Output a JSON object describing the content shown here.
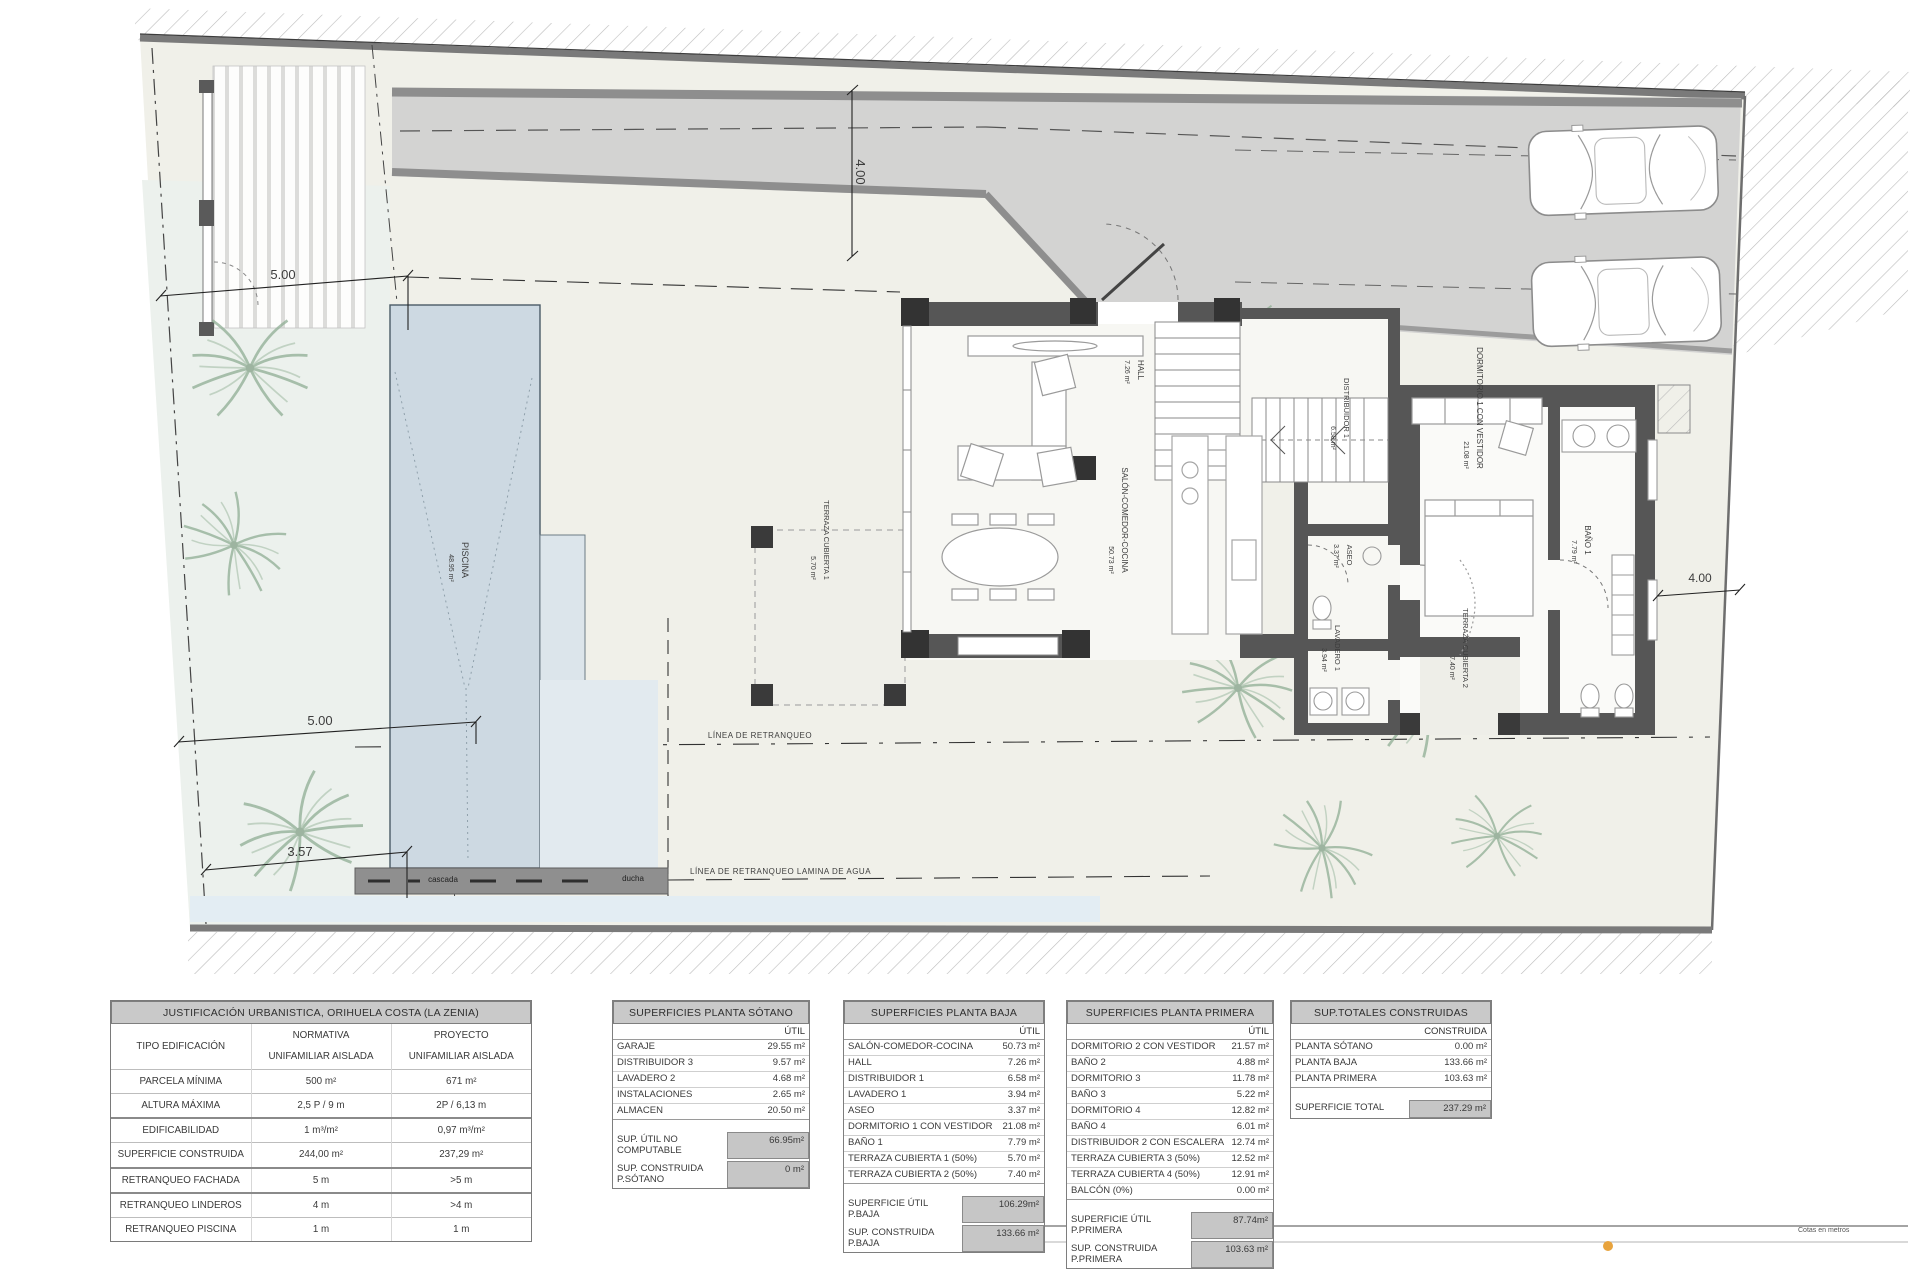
{
  "plan": {
    "colors": {
      "wall": "#565656",
      "pool": "#cdd9e2",
      "road": "#d3d3d2",
      "highlight": "#c6c6c6",
      "accent_dot": "#e8a33d"
    },
    "labels": [
      {
        "name": "dimension-label",
        "text": "5.00",
        "x": 283,
        "y": 279,
        "size": 13
      },
      {
        "name": "dimension-label",
        "text": "4.00",
        "x": 856,
        "y": 172,
        "size": 13,
        "rot": 90
      },
      {
        "name": "dimension-label",
        "text": "5.00",
        "x": 320,
        "y": 725,
        "size": 13
      },
      {
        "name": "dimension-label",
        "text": "3.57",
        "x": 300,
        "y": 856,
        "size": 13
      },
      {
        "name": "dimension-label",
        "text": "4.00",
        "x": 1700,
        "y": 582,
        "size": 12
      },
      {
        "name": "setback-line-label",
        "text": "LÍNEA DE RETRANQUEO",
        "x": 760,
        "y": 738,
        "size": 8,
        "anchor": "middle",
        "spacing": ".5"
      },
      {
        "name": "setback-line-label",
        "text": "LÍNEA DE RETRANQUEO LAMINA DE AGUA",
        "x": 690,
        "y": 874,
        "size": 8,
        "anchor": "start",
        "spacing": ".5"
      },
      {
        "name": "deck-label",
        "text": "cascada",
        "x": 443,
        "y": 882,
        "size": 8,
        "color": "#222"
      },
      {
        "name": "deck-label",
        "text": "ducha",
        "x": 633,
        "y": 881,
        "size": 8,
        "color": "#222"
      },
      {
        "name": "room-label",
        "text": "PISCINA",
        "x": 462,
        "y": 560,
        "size": 9,
        "rot": 90
      },
      {
        "name": "room-area-label",
        "text": "48.95 m²",
        "x": 449,
        "y": 568,
        "size": 7,
        "rot": 90
      },
      {
        "name": "room-label",
        "text": "HALL",
        "x": 1138,
        "y": 370,
        "size": 8,
        "rot": 90
      },
      {
        "name": "room-area-label",
        "text": "7.26 m²",
        "x": 1125,
        "y": 372,
        "size": 7,
        "rot": 90
      },
      {
        "name": "room-label",
        "text": "SALÓN-COMEDOR-COCINA",
        "x": 1122,
        "y": 520,
        "size": 8,
        "rot": 90
      },
      {
        "name": "room-area-label",
        "text": "50.73 m²",
        "x": 1109,
        "y": 560,
        "size": 7,
        "rot": 90
      },
      {
        "name": "room-label",
        "text": "DISTRIBUIDOR 1",
        "x": 1344,
        "y": 408,
        "size": 7.5,
        "rot": 90
      },
      {
        "name": "room-area-label",
        "text": "6.58 m²",
        "x": 1331,
        "y": 438,
        "size": 7,
        "rot": 90
      },
      {
        "name": "room-label",
        "text": "ASEO",
        "x": 1347,
        "y": 555,
        "size": 7.5,
        "rot": 90
      },
      {
        "name": "room-area-label",
        "text": "3.37 m²",
        "x": 1334,
        "y": 556,
        "size": 7,
        "rot": 90
      },
      {
        "name": "room-label",
        "text": "LAVADERO 1",
        "x": 1335,
        "y": 648,
        "size": 7.5,
        "rot": 90
      },
      {
        "name": "room-area-label",
        "text": "3.94 m²",
        "x": 1322,
        "y": 660,
        "size": 7,
        "rot": 90
      },
      {
        "name": "room-label",
        "text": "DORMITORIO 1 CON VESTIDOR",
        "x": 1477,
        "y": 408,
        "size": 8,
        "rot": 90
      },
      {
        "name": "room-area-label",
        "text": "21.08 m²",
        "x": 1464,
        "y": 455,
        "size": 7,
        "rot": 90
      },
      {
        "name": "room-label",
        "text": "BAÑO 1",
        "x": 1585,
        "y": 540,
        "size": 8,
        "rot": 90
      },
      {
        "name": "room-area-label",
        "text": "7.79 m²",
        "x": 1572,
        "y": 552,
        "size": 7,
        "rot": 90
      },
      {
        "name": "room-label",
        "text": "TERRAZA CUBIERTA 1",
        "x": 824,
        "y": 540,
        "size": 7.5,
        "rot": 90
      },
      {
        "name": "room-area-label",
        "text": "5.70 m²",
        "x": 811,
        "y": 568,
        "size": 7,
        "rot": 90
      },
      {
        "name": "room-label",
        "text": "TERRAZA CUBIERTA 2",
        "x": 1463,
        "y": 648,
        "size": 7.5,
        "rot": 90
      },
      {
        "name": "room-area-label",
        "text": "7.40 m²",
        "x": 1450,
        "y": 668,
        "size": 7,
        "rot": 90
      },
      {
        "name": "scale-zero-label",
        "text": "0",
        "x": 997,
        "y": 1238,
        "size": 9,
        "color": "#222"
      },
      {
        "name": "scale-note-label",
        "text": "Cotas en metros",
        "x": 1798,
        "y": 1232,
        "size": 7,
        "anchor": "start",
        "color": "#555"
      }
    ]
  },
  "tables": {
    "urbanistica": {
      "title": "JUSTIFICACIÓN URBANISTICA, ORIHUELA COSTA (LA ZENIA)",
      "first_row": {
        "label": "TIPO EDIFICACIÓN",
        "headers": [
          "NORMATIVA",
          "PROYECTO"
        ],
        "values": [
          "UNIFAMILIAR AISLADA",
          "UNIFAMILIAR AISLADA"
        ]
      },
      "rows": [
        {
          "label": "PARCELA MÍNIMA",
          "normativa": "500 m²",
          "proyecto": "671 m²",
          "heavy": false
        },
        {
          "label": "ALTURA MÁXIMA",
          "normativa": "2,5 P / 9 m",
          "proyecto": "2P / 6,13 m",
          "heavy": false
        },
        {
          "label": "EDIFICABILIDAD",
          "normativa": "1 m³/m²",
          "proyecto": "0,97 m³/m²",
          "heavy": true
        },
        {
          "label": "SUPERFICIE CONSTRUIDA",
          "normativa": "244,00 m²",
          "proyecto": "237,29 m²",
          "heavy": false
        },
        {
          "label": "RETRANQUEO FACHADA",
          "normativa": "5 m",
          "proyecto": ">5 m",
          "heavy": true
        },
        {
          "label": "RETRANQUEO LINDEROS",
          "normativa": "4 m",
          "proyecto": ">4 m",
          "heavy": true
        },
        {
          "label": "RETRANQUEO PISCINA",
          "normativa": "1 m",
          "proyecto": "1 m",
          "heavy": false
        }
      ]
    },
    "sotano": {
      "title": "SUPERFICIES PLANTA SÓTANO",
      "col_header": "ÚTIL",
      "rows": [
        [
          "GARAJE",
          "29.55 m²"
        ],
        [
          "DISTRIBUIDOR 3",
          "9.57 m²"
        ],
        [
          "LAVADERO 2",
          "4.68 m²"
        ],
        [
          "INSTALACIONES",
          "2.65 m²"
        ],
        [
          "ALMACEN",
          "20.50 m²"
        ]
      ],
      "summary": [
        [
          "SUP. ÚTIL NO COMPUTABLE",
          "66.95m²"
        ],
        [
          "SUP. CONSTRUIDA P.SÓTANO",
          "0 m²"
        ]
      ]
    },
    "baja": {
      "title": "SUPERFICIES PLANTA BAJA",
      "col_header": "ÚTIL",
      "rows": [
        [
          "SALÓN-COMEDOR-COCINA",
          "50.73 m²"
        ],
        [
          "HALL",
          "7.26 m²"
        ],
        [
          "DISTRIBUIDOR 1",
          "6.58 m²"
        ],
        [
          "LAVADERO 1",
          "3.94 m²"
        ],
        [
          "ASEO",
          "3.37 m²"
        ],
        [
          "DORMITORIO 1 CON VESTIDOR",
          "21.08 m²"
        ],
        [
          "BAÑO 1",
          "7.79 m²"
        ],
        [
          "TERRAZA CUBIERTA 1 (50%)",
          "5.70 m²"
        ],
        [
          "TERRAZA CUBIERTA 2 (50%)",
          "7.40 m²"
        ]
      ],
      "summary": [
        [
          "SUPERFICIE ÚTIL P.BAJA",
          "106.29m²"
        ],
        [
          "SUP. CONSTRUIDA P.BAJA",
          "133.66 m²"
        ]
      ]
    },
    "primera": {
      "title": "SUPERFICIES PLANTA PRIMERA",
      "col_header": "ÚTIL",
      "rows": [
        [
          "DORMITORIO 2 CON VESTIDOR",
          "21.57 m²"
        ],
        [
          "BAÑO 2",
          "4.88 m²"
        ],
        [
          "DORMITORIO 3",
          "11.78 m²"
        ],
        [
          "BAÑO 3",
          "5.22 m²"
        ],
        [
          "DORMITORIO 4",
          "12.82 m²"
        ],
        [
          "BAÑO 4",
          "6.01 m²"
        ],
        [
          "DISTRIBUIDOR 2 CON ESCALERA",
          "12.74 m²"
        ],
        [
          "TERRAZA CUBIERTA 3 (50%)",
          "12.52 m²"
        ],
        [
          "TERRAZA CUBIERTA 4 (50%)",
          "12.91 m²"
        ],
        [
          "BALCÓN (0%)",
          "0.00 m²"
        ]
      ],
      "summary": [
        [
          "SUPERFICIE ÚTIL P.PRIMERA",
          "87.74m²"
        ],
        [
          "SUP. CONSTRUIDA P.PRIMERA",
          "103.63 m²"
        ]
      ]
    },
    "totales": {
      "title": "SUP.TOTALES CONSTRUIDAS",
      "col_header": "CONSTRUIDA",
      "rows": [
        [
          "PLANTA SÓTANO",
          "0.00 m²"
        ],
        [
          "PLANTA BAJA",
          "133.66 m²"
        ],
        [
          "PLANTA PRIMERA",
          "103.63 m²"
        ]
      ],
      "summary": [
        [
          "SUPERFICIE TOTAL",
          "237.29 m²"
        ]
      ]
    }
  }
}
